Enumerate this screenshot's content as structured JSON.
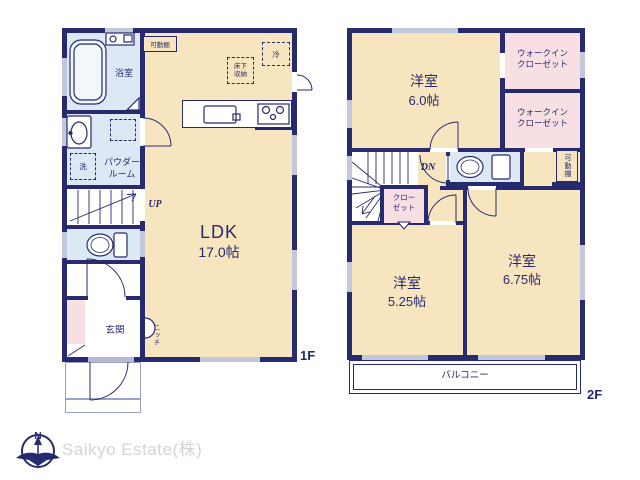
{
  "floor1": {
    "floor_label": "1F",
    "bathroom": "浴室",
    "powder_room": "パウダー\nルーム",
    "laundry": "洗",
    "movable_shelf": "可動棚",
    "refrigerator": "冷",
    "underfloor_storage": "床下\n収納",
    "stairs_label": "UP",
    "ldk_name": "LDK",
    "ldk_size": "17.0帖",
    "entrance": "玄関",
    "niche": "ニッチ"
  },
  "floor2": {
    "floor_label": "2F",
    "bedroom_a_name": "洋室",
    "bedroom_a_size": "6.0帖",
    "wic_a": "ウォークイン\nクローゼット",
    "wic_b": "ウォークイン\nクローゼット",
    "stairs_label": "DN",
    "closet": "クロー\nゼット",
    "movable_shelf": "可動棚",
    "bedroom_b_name": "洋室",
    "bedroom_b_size": "5.25帖",
    "bedroom_c_name": "洋室",
    "bedroom_c_size": "6.75帖",
    "balcony": "バルコニー"
  },
  "branding": {
    "company": "Saikyo Estate(株)",
    "compass_north": "N"
  },
  "colors": {
    "wall_navy": "#272a6f",
    "room_cream": "#f7e5bf",
    "room_blue": "#dce9f5",
    "room_pink": "#f8dfe4",
    "window_gray": "#c2c7db",
    "logo_gray": "#d4d4d4"
  }
}
